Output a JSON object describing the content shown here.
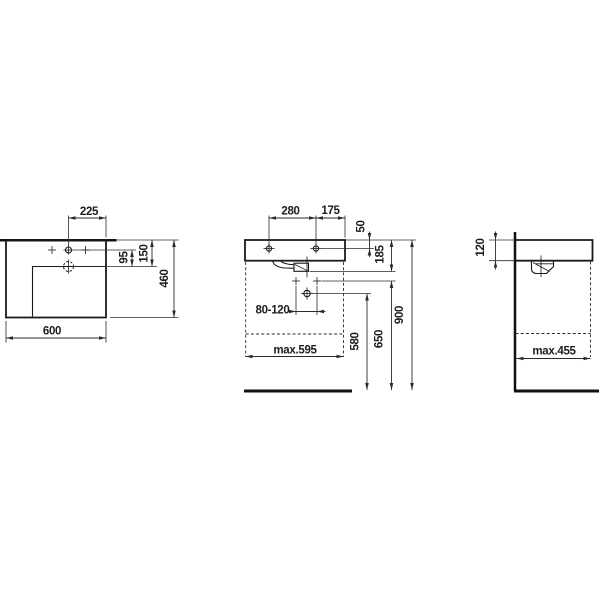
{
  "drawing": {
    "type": "washbasin-installation-dimension-drawing",
    "background": "#ffffff",
    "line_color": "#1a1a1a",
    "views": {
      "top": {
        "dims": {
          "tap_to_edge": "225",
          "tap_to_drain": "95",
          "rim_to_drain": "150",
          "depth": "460",
          "width": "600"
        }
      },
      "front": {
        "dims": {
          "hole_spacing": "280",
          "hole_to_edge": "175",
          "rim_to_holes": "50",
          "rim_to_outlet": "185",
          "waste_range": "80-120",
          "trap_outlet_height": "580",
          "supply_height": "650",
          "rim_height": "900",
          "max_cabinet_width": "max.595"
        }
      },
      "side": {
        "dims": {
          "apron_height": "120",
          "max_cabinet_depth": "max.455"
        }
      }
    }
  }
}
